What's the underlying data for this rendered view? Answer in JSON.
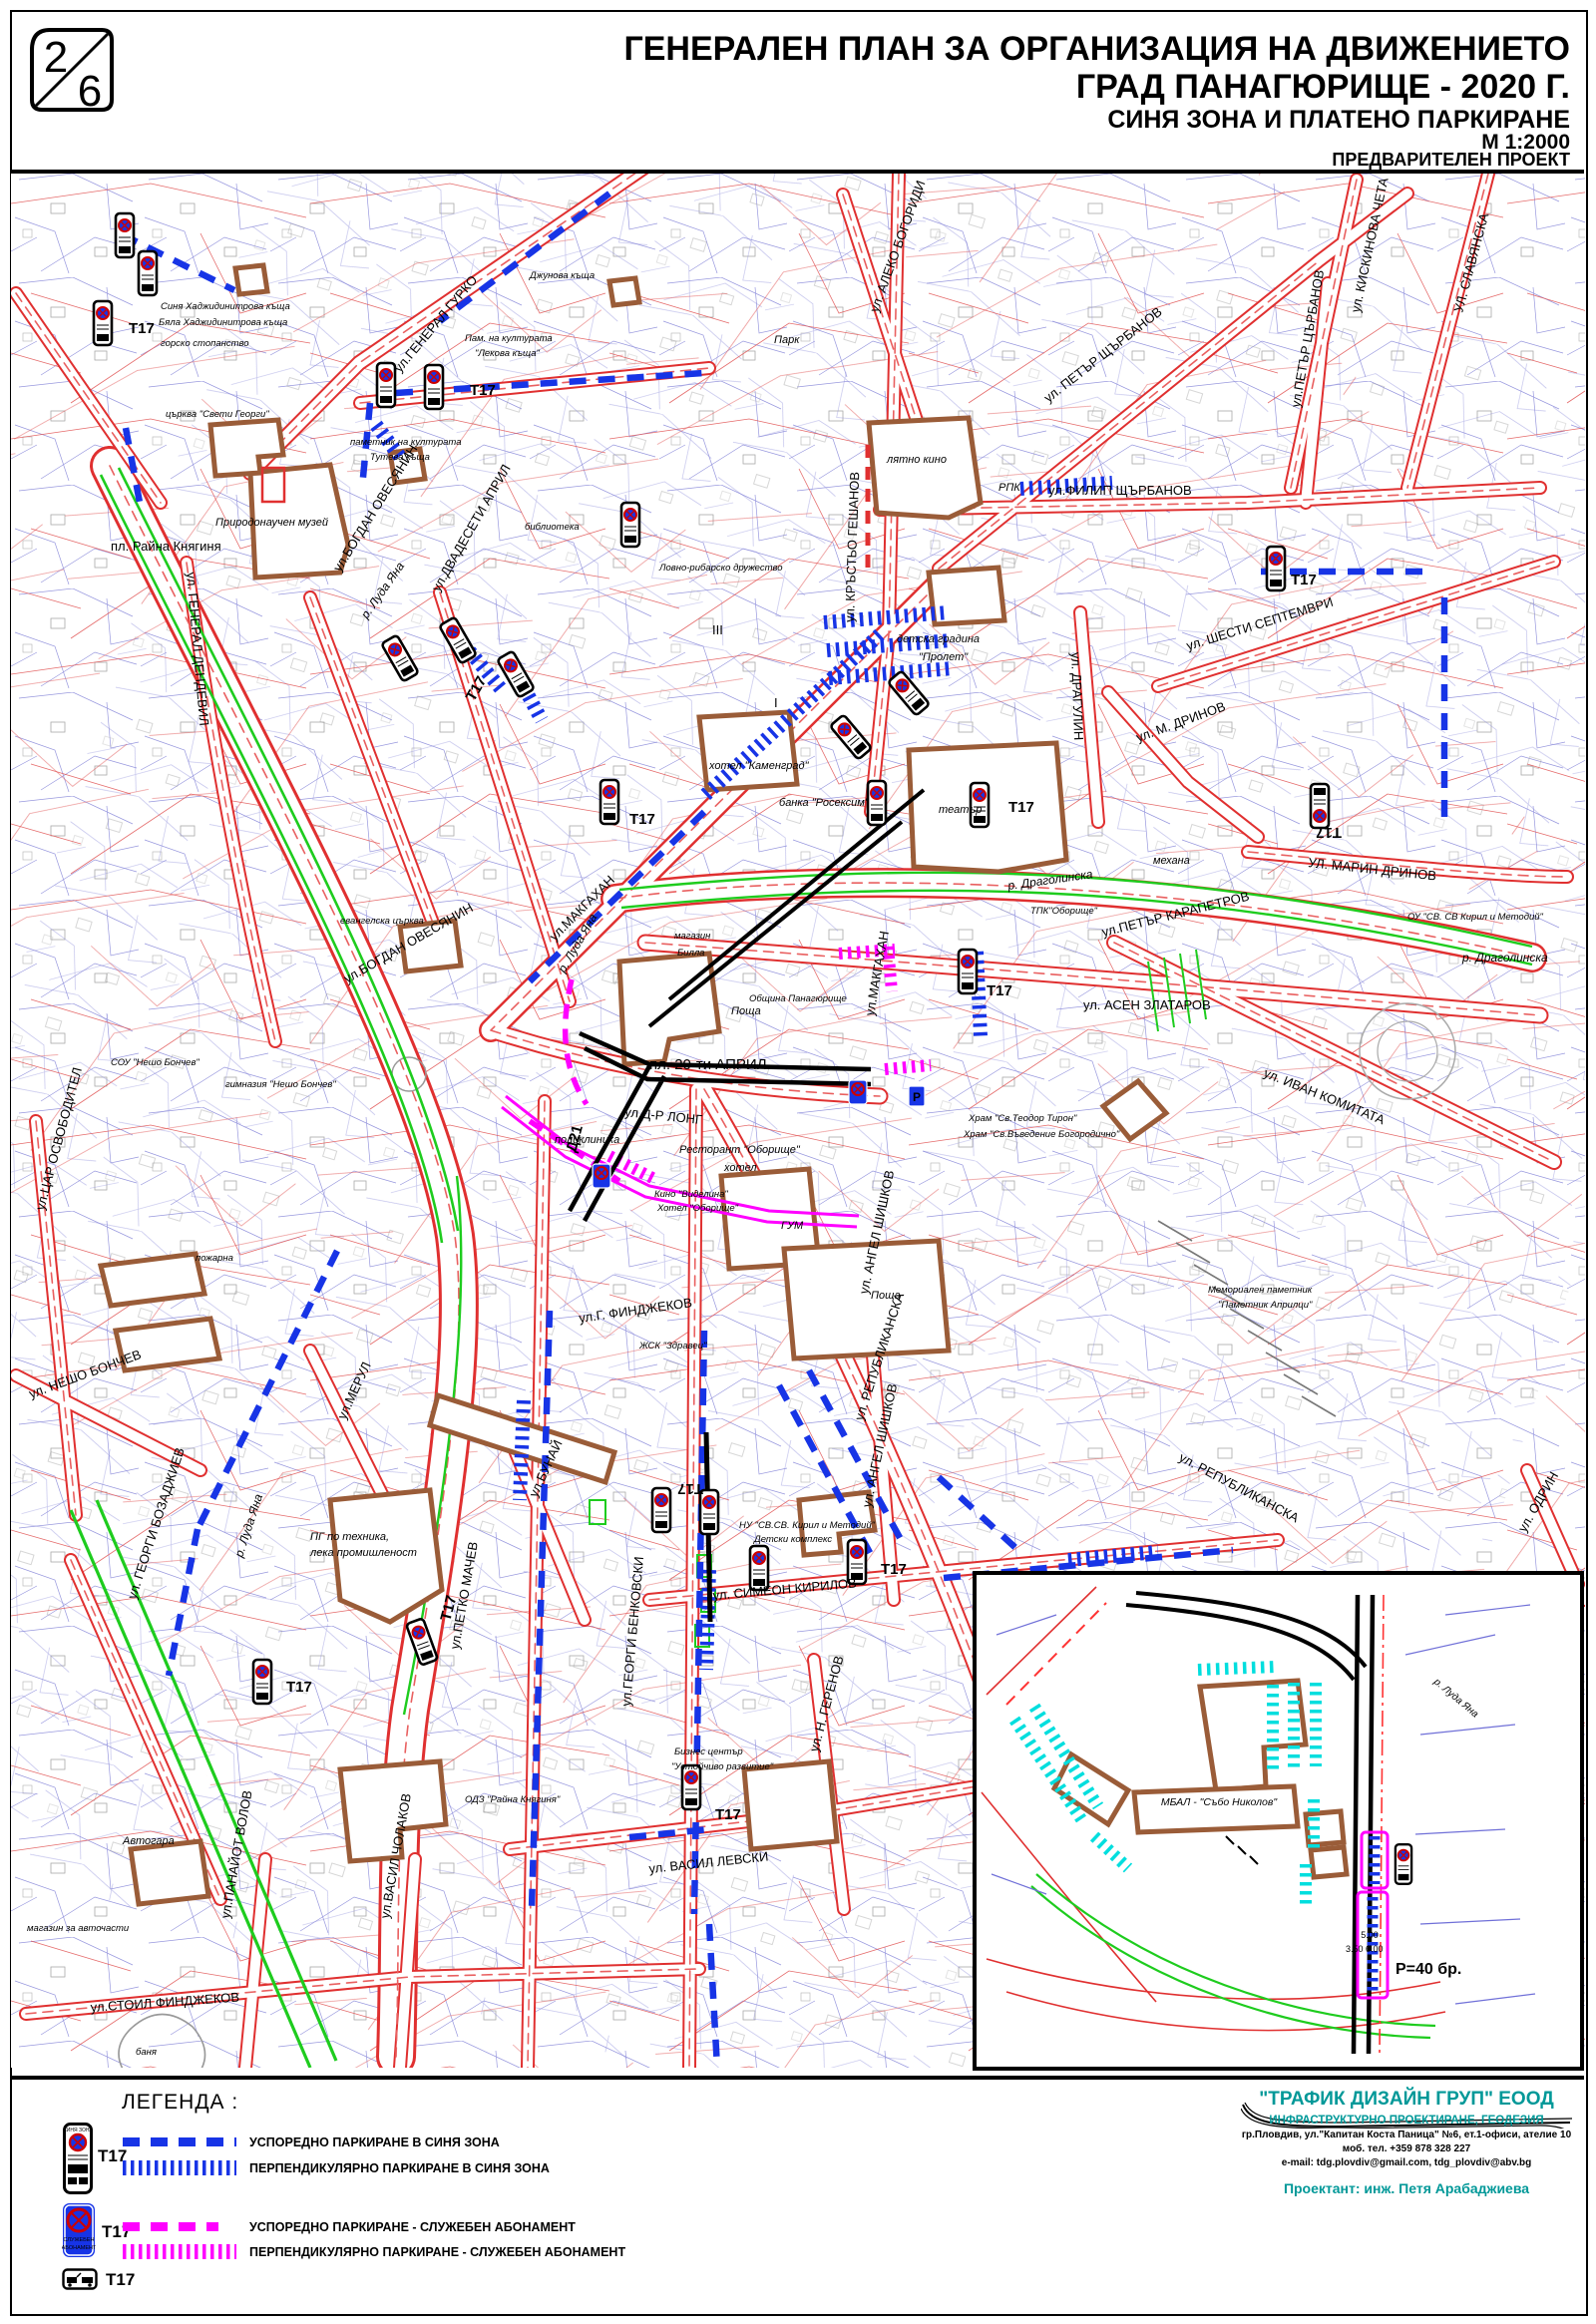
{
  "sheet": {
    "number": "2",
    "total": "6"
  },
  "title": {
    "line1": "ГЕНЕРАЛЕН ПЛАН ЗА ОРГАНИЗАЦИЯ НА ДВИЖЕНИЕТО",
    "line2": "ГРАД ПАНАГЮРИЩЕ -  2020 Г.",
    "line3": "СИНЯ ЗОНА И ПЛАТЕНО ПАРКИРАНЕ",
    "scale": "М 1:2000",
    "stage": "ПРЕДВАРИТЕЛЕН ПРОЕКТ"
  },
  "legend": {
    "heading": "ЛЕГЕНДА :",
    "sign_code": "Т17",
    "sign1_header": "СИНЯ ЗОНА",
    "sign2_line1": "СЛУЖЕБЕН",
    "sign2_line2": "АБОНАМЕНТ",
    "items": [
      {
        "label": "УСПОРЕДНО ПАРКИРАНЕ В СИНЯ ЗОНА",
        "style": "dashed",
        "color": "#1734e6"
      },
      {
        "label": "ПЕРПЕНДИКУЛЯРНО ПАРКИРАНЕ В СИНЯ ЗОНА",
        "style": "hatched",
        "color": "#1734e6"
      },
      {
        "label": "УСПОРЕДНО ПАРКИРАНЕ - СЛУЖЕБЕН АБОНАМЕНТ",
        "style": "dashed",
        "color": "#ff00ff"
      },
      {
        "label": "ПЕРПЕНДИКУЛЯРНО ПАРКИРАНЕ - СЛУЖЕБЕН АБОНАМЕНТ",
        "style": "hatched",
        "color": "#ff00ff"
      }
    ]
  },
  "company": {
    "name": "\"ТРАФИК ДИЗАЙН ГРУП\" ЕООД",
    "field": "ИНФРАСТРУКТУРНО  ПРОЕКТИРАНЕ, ГЕОДЕЗИЯ",
    "address": "гр.Пловдив, ул.\"Капитан Коста Паница\" №6, ет.1-офиси, ателие 10",
    "phone": "моб. тел. +359 878 328 227",
    "email": "e-mail:  tdg.plovdiv@gmail.com, tdg_plovdiv@abv.bg",
    "designer": "Проектант: инж. Петя Арабаджиева"
  },
  "inset": {
    "hospital": "МБАЛ - \"Събо Николов\"",
    "capacity": "Р=40 бр.",
    "dim_a": "5.00",
    "dim_b": "3.50 6.00",
    "river": "р. Луда Яна"
  },
  "map": {
    "sign_code": "Т17",
    "d21_code": "Д21",
    "labels": {
      "raina": "пл. Райна Княгиня",
      "gurko": "ул.ГЕНЕРАЛ ГУРКО",
      "dzhunova": "Джунова къща",
      "sinya_k": "Синя Хаджидинитрова къща",
      "byala_k": "Бяла Хаджидинитрова къща",
      "gorsko": "горско стопанство",
      "pam1": "Пам. на културата",
      "pam2": "\"Лекова къща\"",
      "park": "Парк",
      "tsarkva": "църква \"Свети Георги\"",
      "muzey": "Природонаучен музей",
      "tuteva1": "паметник на културата",
      "tuteva2": "Тутева къща",
      "biblioteka": "библиотека",
      "lovno": "Ловно-рибарско дружество",
      "dendevil": "ул. ГЕНЕРАЛ ДЕНДЕВИЛ",
      "bogdan": "ул.БОГДАН ОВЕСЯНИН",
      "dvadeseti": "ул.ДВАДЕСЕТИ АПРИЛ",
      "aleko": "ул. АЛЕКО БОГОРИДИ",
      "krastyo": "ул. КРЪСТЬО ГЕШАНОВ",
      "petar1": "ул. ПЕТЪР ЩЪРБАНОВ",
      "petar2": "ул.ПЕТЪР ЦЪРБАНОВ",
      "kiskinova": "ул. КИСКИНОВА ЧЕТА",
      "slavyanska": "УЛ. СЛАВЯНСКА",
      "filip": "ул.ФИЛИП ЩЪРБАНОВ",
      "shesti": "ул. ШЕСТИ СЕПТЕМВРИ",
      "lyatno": "лятно кино",
      "rpk": "РПК",
      "prolet1": "детска градина",
      "prolet2": "\"Пролет\"",
      "dragulin": "ул. ДРАГУЛИН",
      "mdrinov": "ул. М. ДРИНОВ",
      "marin": "УЛ. МАРИН ДРИНОВ",
      "ou": "ОУ \"СВ. СВ Кирил и Методий\"",
      "mehana": "механа",
      "kamengrad": "хотел \"Каменград\"",
      "roseksim": "банка \"Росексим\"",
      "teatar": "театър",
      "dragolinska": "р. Драголинска",
      "karapetrov": "ул.ПЕТЪР КАРАПЕТРОВ",
      "tpk": "ТПК\"Оборище\"",
      "asen": "ул. АСЕН ЗЛАТАРОВ",
      "ivan": "ул. ИВАН КОМИТАТА",
      "mem1": "Мемориален паметник",
      "mem2": "\"Паметник Априлци\"",
      "hram1": "Храм \"Св.Теодор Тирон\"",
      "hram2": "Храм \"Св.Въведение Богородично\"",
      "makgahan": "ул.МАКГАХАН",
      "luda": "р. Луда Яна",
      "evangelska": "евангелска църква",
      "magazin": "магазин",
      "billa": "Билла",
      "obshtina": "Община Панагюрище",
      "poshta": "Поща",
      "pl20": "пл. 20-ти АПРИЛ",
      "drlong": "ул.Д-Р ЛОНГ",
      "poliklinika": "поликлиника",
      "restorant": "Ресторант \"Оборище\"",
      "hotel": "хотел",
      "kino": "Кино \"Виделина\"",
      "hotelob": "Хотел \"Оборище\"",
      "gum": "ГУМ",
      "zdravec": "ЖСК \"Здравец\"",
      "republikanska": "ул. РЕПУБЛИКАНСКА",
      "sou": "СОУ \"Нешо Бончев\"",
      "gimnazia": "гимназия \"Нешо Бончев\"",
      "carosv": "ул.ЦАР ОСВОБОДИТЕЛ",
      "pozharna": "пожарна",
      "nesho": "ул. НЕШО БОНЧЕВ",
      "merul": "ул.МЕРУЛ",
      "avtogara": "Автогара",
      "magavto": "магазин за авточасти",
      "bozadzhiev": "ул. ГЕОРГИ БОЗАДЖИЕВ",
      "pg1": "ПГ по техника,",
      "pg2": "лека промишленост",
      "bunay": "ул.БУНАЙ",
      "petko": "ул.ПЕТКО МАЧЕВ",
      "benkovski": "ул.ГЕОРГИ БЕНКОВСКИ",
      "simeon": "ул. СИМЕОН КИРИЛОВ",
      "nu": "НУ \"СВ.СВ. Кирил и Методий\"",
      "detski": "Детски комплекс",
      "odz": "ОДЗ \"Райна Княгиня\"",
      "biznes1": "Бизнес център",
      "biznes2": "\"Устойчиво развитие\"",
      "levski": "ул. ВАСИЛ ЛЕВСКИ",
      "gerenov": "ул. Н. ГЕРЕНОВ",
      "shishkov": "ул. АНГЕЛ ШИШКОВ",
      "panayot": "ул.ПАНАЙОТ ВОЛОВ",
      "cholakov": "ул.ВАСИЛ ЧОЛАКОВ",
      "stoil": "ул.СТОИЛ ФИНДЖЕКОВ",
      "banya": "баня",
      "gfin": "ул.Г. ФИНДЖЕКОВ",
      "odrin": "ул. ОДРИН",
      "num3": "III",
      "num1": "I"
    }
  },
  "colors": {
    "blue_zone": "#1734e6",
    "service": "#ff00ff",
    "inset_parking": "#00dede",
    "company_teal": "#009898",
    "road_red": "#e03030",
    "parcel_blue": "#7070d8",
    "building_brown": "#9a5c38",
    "green": "#1ecc1e"
  }
}
